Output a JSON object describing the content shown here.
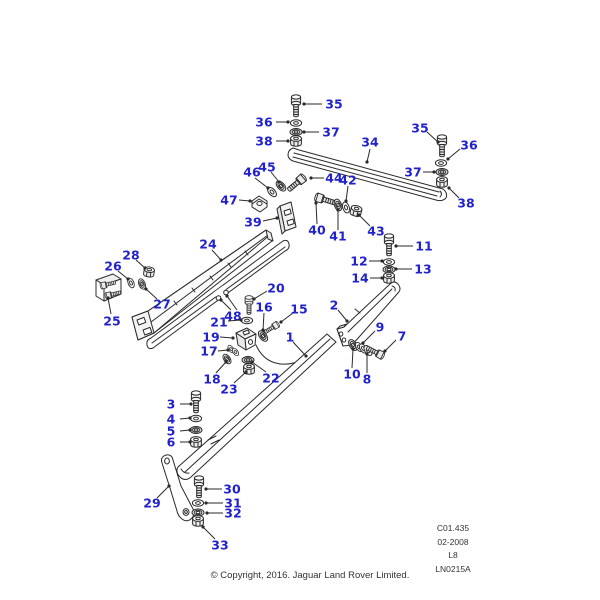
{
  "diagram": {
    "type": "exploded-parts-diagram",
    "description_visible_text_only": true
  },
  "colors": {
    "callout": "#2222cc",
    "line": "#2a2a2a",
    "background": "#ffffff",
    "footer_text": "#333333"
  },
  "reference": {
    "lines": [
      "C01.435",
      "02-2008",
      "L8",
      "LN0215A"
    ]
  },
  "footer": {
    "copyright": "© Copyright, 2016. Jaguar Land Rover Limited."
  },
  "callouts": [
    {
      "n": "35",
      "x": 334,
      "y": 104,
      "l": [
        [
          322,
          104,
          304,
          104
        ]
      ]
    },
    {
      "n": "36",
      "x": 264,
      "y": 122,
      "l": [
        [
          276,
          122,
          288,
          122
        ]
      ]
    },
    {
      "n": "37",
      "x": 331,
      "y": 132,
      "l": [
        [
          319,
          132,
          304,
          132
        ]
      ]
    },
    {
      "n": "38",
      "x": 264,
      "y": 141,
      "l": [
        [
          276,
          141,
          288,
          141
        ]
      ]
    },
    {
      "n": "34",
      "x": 370,
      "y": 142,
      "l": [
        [
          370,
          149,
          367,
          162
        ]
      ]
    },
    {
      "n": "35",
      "x": 420,
      "y": 128,
      "l": [
        [
          427,
          132,
          438,
          142
        ]
      ]
    },
    {
      "n": "36",
      "x": 469,
      "y": 145,
      "l": [
        [
          460,
          149,
          448,
          159
        ]
      ]
    },
    {
      "n": "37",
      "x": 413,
      "y": 172,
      "l": [
        [
          423,
          172,
          434,
          172
        ]
      ]
    },
    {
      "n": "38",
      "x": 466,
      "y": 203,
      "l": [
        [
          459,
          198,
          449,
          188
        ]
      ]
    },
    {
      "n": "46",
      "x": 252,
      "y": 172,
      "l": [
        [
          255,
          178,
          268,
          188
        ]
      ]
    },
    {
      "n": "45",
      "x": 267,
      "y": 167,
      "l": [
        [
          271,
          172,
          279,
          182
        ]
      ]
    },
    {
      "n": "44",
      "x": 334,
      "y": 178,
      "l": [
        [
          324,
          178,
          311,
          178
        ]
      ]
    },
    {
      "n": "42",
      "x": 348,
      "y": 180,
      "l": [
        [
          348,
          186,
          346,
          201
        ]
      ]
    },
    {
      "n": "47",
      "x": 229,
      "y": 200,
      "l": [
        [
          239,
          200,
          250,
          201
        ]
      ]
    },
    {
      "n": "39",
      "x": 253,
      "y": 222,
      "l": [
        [
          263,
          221,
          277,
          218
        ]
      ]
    },
    {
      "n": "40",
      "x": 317,
      "y": 230,
      "l": [
        [
          317,
          224,
          316,
          203
        ]
      ]
    },
    {
      "n": "41",
      "x": 338,
      "y": 236,
      "l": [
        [
          338,
          230,
          338,
          210
        ]
      ]
    },
    {
      "n": "43",
      "x": 376,
      "y": 231,
      "l": [
        [
          370,
          226,
          359,
          215
        ]
      ]
    },
    {
      "n": "11",
      "x": 424,
      "y": 246,
      "l": [
        [
          413,
          246,
          396,
          246
        ]
      ]
    },
    {
      "n": "12",
      "x": 359,
      "y": 261,
      "l": [
        [
          369,
          261,
          382,
          261
        ]
      ]
    },
    {
      "n": "13",
      "x": 423,
      "y": 269,
      "l": [
        [
          412,
          269,
          396,
          269
        ]
      ]
    },
    {
      "n": "14",
      "x": 360,
      "y": 278,
      "l": [
        [
          370,
          278,
          382,
          278
        ]
      ]
    },
    {
      "n": "24",
      "x": 208,
      "y": 244,
      "l": [
        [
          212,
          250,
          221,
          260
        ]
      ]
    },
    {
      "n": "28",
      "x": 131,
      "y": 255,
      "l": [
        [
          136,
          260,
          145,
          268
        ]
      ]
    },
    {
      "n": "26",
      "x": 113,
      "y": 266,
      "l": [
        [
          118,
          271,
          128,
          279
        ]
      ]
    },
    {
      "n": "27",
      "x": 162,
      "y": 304,
      "l": [
        [
          157,
          299,
          146,
          289
        ]
      ]
    },
    {
      "n": "25",
      "x": 112,
      "y": 321,
      "l": [
        [
          111,
          314,
          108,
          298
        ]
      ]
    },
    {
      "n": "20",
      "x": 276,
      "y": 288,
      "l": [
        [
          267,
          291,
          254,
          299
        ]
      ]
    },
    {
      "n": "48",
      "x": 233,
      "y": 316,
      "l": [
        [
          231,
          310,
          221,
          300
        ],
        [
          237,
          310,
          227,
          296
        ]
      ]
    },
    {
      "n": "21",
      "x": 219,
      "y": 322,
      "l": [
        [
          228,
          321,
          241,
          320
        ]
      ]
    },
    {
      "n": "16",
      "x": 264,
      "y": 307,
      "l": [
        [
          264,
          313,
          263,
          330
        ]
      ]
    },
    {
      "n": "15",
      "x": 299,
      "y": 309,
      "l": [
        [
          293,
          313,
          281,
          322
        ]
      ]
    },
    {
      "n": "19",
      "x": 211,
      "y": 337,
      "l": [
        [
          220,
          337,
          233,
          338
        ]
      ]
    },
    {
      "n": "17",
      "x": 209,
      "y": 351,
      "l": [
        [
          218,
          351,
          228,
          350
        ]
      ]
    },
    {
      "n": "18",
      "x": 212,
      "y": 379,
      "l": [
        [
          216,
          373,
          226,
          362
        ]
      ]
    },
    {
      "n": "23",
      "x": 229,
      "y": 389,
      "l": [
        [
          234,
          383,
          246,
          372
        ]
      ]
    },
    {
      "n": "22",
      "x": 271,
      "y": 378,
      "l": [
        [
          266,
          372,
          252,
          362
        ]
      ]
    },
    {
      "n": "1",
      "x": 290,
      "y": 337,
      "l": [
        [
          293,
          342,
          306,
          356
        ]
      ]
    },
    {
      "n": "2",
      "x": 334,
      "y": 305,
      "l": [
        [
          338,
          310,
          347,
          321
        ]
      ]
    },
    {
      "n": "9",
      "x": 380,
      "y": 327,
      "l": [
        [
          375,
          331,
          363,
          343
        ]
      ]
    },
    {
      "n": "7",
      "x": 402,
      "y": 336,
      "l": [
        [
          396,
          340,
          385,
          351
        ]
      ]
    },
    {
      "n": "10",
      "x": 352,
      "y": 374,
      "l": [
        [
          352,
          368,
          353,
          349
        ]
      ]
    },
    {
      "n": "8",
      "x": 367,
      "y": 379,
      "l": [
        [
          367,
          373,
          367,
          354
        ]
      ]
    },
    {
      "n": "3",
      "x": 171,
      "y": 404,
      "l": [
        [
          180,
          404,
          191,
          404
        ]
      ]
    },
    {
      "n": "4",
      "x": 171,
      "y": 419,
      "l": [
        [
          180,
          419,
          190,
          418
        ]
      ]
    },
    {
      "n": "5",
      "x": 171,
      "y": 431,
      "l": [
        [
          180,
          431,
          190,
          430
        ]
      ]
    },
    {
      "n": "6",
      "x": 171,
      "y": 442,
      "l": [
        [
          180,
          442,
          190,
          442
        ]
      ]
    },
    {
      "n": "29",
      "x": 152,
      "y": 503,
      "l": [
        [
          157,
          498,
          169,
          486
        ]
      ]
    },
    {
      "n": "30",
      "x": 232,
      "y": 489,
      "l": [
        [
          222,
          489,
          206,
          489
        ]
      ]
    },
    {
      "n": "31",
      "x": 233,
      "y": 503,
      "l": [
        [
          223,
          503,
          206,
          503
        ]
      ]
    },
    {
      "n": "32",
      "x": 233,
      "y": 513,
      "l": [
        [
          223,
          513,
          207,
          513
        ]
      ]
    },
    {
      "n": "33",
      "x": 220,
      "y": 545,
      "l": [
        [
          215,
          539,
          203,
          527
        ]
      ]
    }
  ]
}
